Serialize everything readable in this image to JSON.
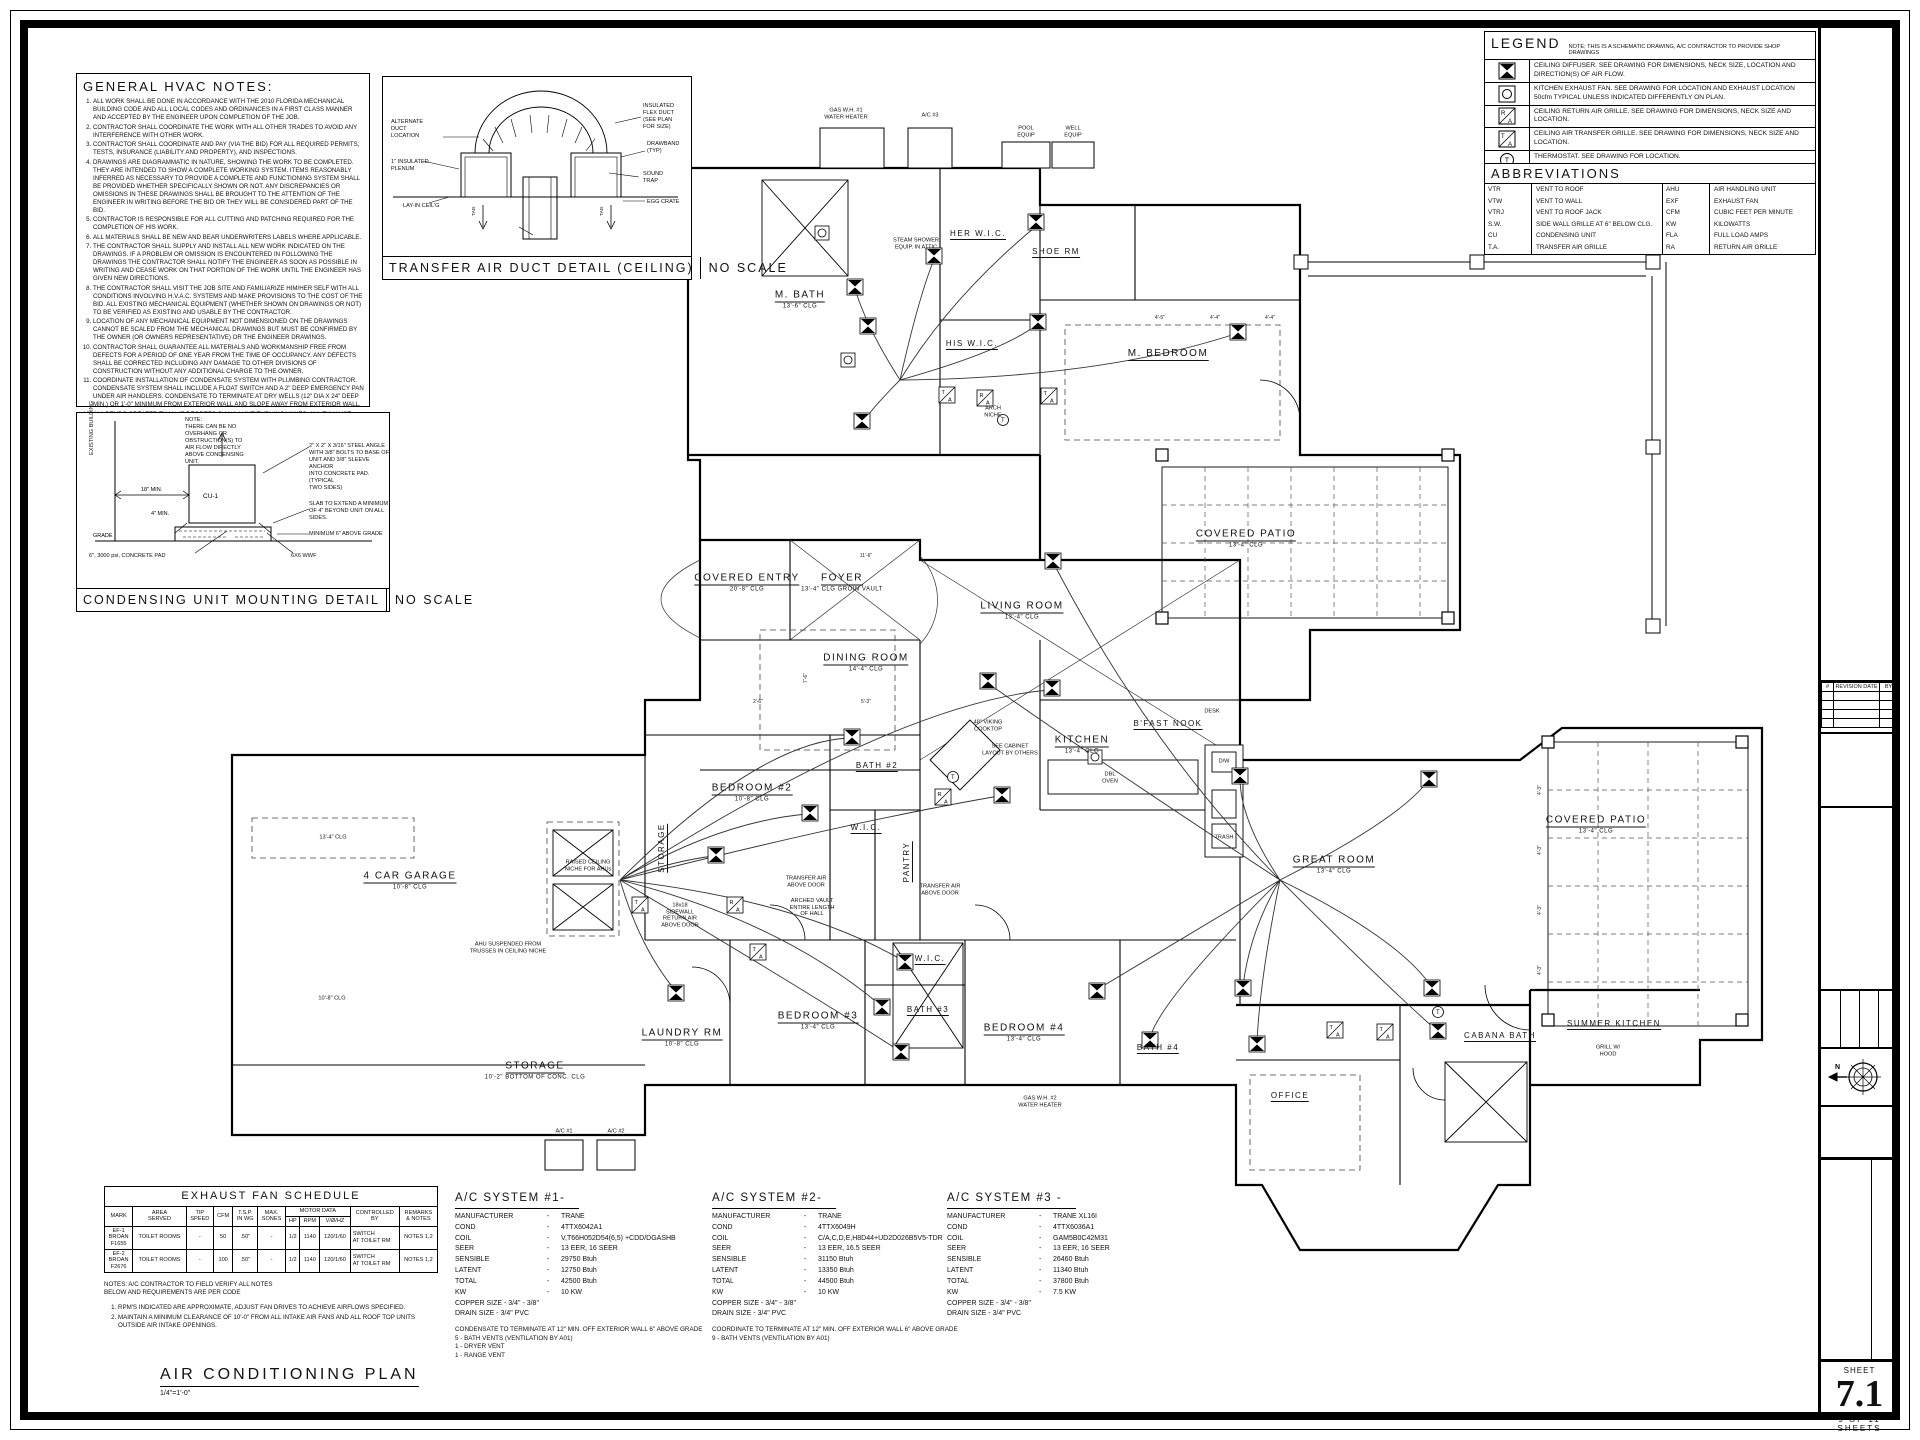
{
  "general_notes": {
    "title": "GENERAL HVAC NOTES:",
    "items": [
      "ALL WORK SHALL BE DONE IN ACCORDANCE WITH THE 2010 FLORIDA MECHANICAL BUILDING CODE AND ALL LOCAL CODES AND ORDINANCES IN A FIRST CLASS MANNER AND ACCEPTED BY THE ENGINEER UPON COMPLETION OF THE JOB.",
      "CONTRACTOR SHALL COORDINATE THE WORK WITH ALL OTHER TRADES TO AVOID ANY INTERFERENCE WITH OTHER WORK.",
      "CONTRACTOR SHALL COORDINATE AND PAY (VIA THE BID) FOR ALL REQUIRED PERMITS, TESTS, INSURANCE (LIABILITY AND PROPERTY), AND INSPECTIONS.",
      "DRAWINGS ARE DIAGRAMMATIC IN NATURE, SHOWING THE WORK TO BE COMPLETED. THEY ARE INTENDED TO SHOW A COMPLETE WORKING SYSTEM. ITEMS REASONABLY INFERRED AS NECESSARY TO PROVIDE A COMPLETE AND FUNCTIONING SYSTEM SHALL BE PROVIDED WHETHER SPECIFICALLY SHOWN OR NOT. ANY DISCREPANCIES OR OMISSIONS IN THESE DRAWINGS SHALL BE BROUGHT TO THE ATTENTION OF THE ENGINEER IN WRITING BEFORE THE BID OR THEY WILL BE CONSIDERED PART OF THE BID.",
      "CONTRACTOR IS RESPONSIBLE FOR ALL CUTTING AND PATCHING REQUIRED FOR THE COMPLETION OF HIS WORK.",
      "ALL MATERIALS SHALL BE NEW AND BEAR UNDERWRITERS LABELS WHERE APPLICABLE.",
      "THE CONTRACTOR SHALL SUPPLY AND INSTALL ALL NEW WORK INDICATED ON THE DRAWINGS. IF A PROBLEM OR OMISSION IS ENCOUNTERED IN FOLLOWING THE DRAWINGS THE CONTRACTOR SHALL NOTIFY THE ENGINEER AS SOON AS POSSIBLE IN WRITING AND CEASE WORK ON THAT PORTION OF THE WORK UNTIL THE ENGINEER HAS GIVEN NEW DIRECTIONS.",
      "THE CONTRACTOR SHALL VISIT THE JOB SITE AND FAMILIARIZE HIM/HER SELF WITH ALL CONDITIONS INVOLVING H.V.A.C. SYSTEMS AND MAKE PROVISIONS TO THE COST OF THE BID. ALL EXISTING MECHANICAL EQUIPMENT (WHETHER SHOWN ON DRAWINGS OR NOT) TO BE VERIFIED AS EXISTING AND USABLE BY THE CONTRACTOR.",
      "LOCATION OF ANY MECHANICAL EQUIPMENT NOT DIMENSIONED ON THE DRAWINGS CANNOT BE SCALED FROM THE MECHANICAL DRAWINGS BUT MUST BE CONFIRMED BY THE OWNER (OR OWNERS REPRESENTATIVE) OR THE ENGINEER DRAWINGS.",
      "CONTRACTOR SHALL GUARANTEE ALL MATERIALS AND WORKMANSHIP FREE FROM DEFECTS FOR A PERIOD OF ONE YEAR FROM THE TIME OF OCCUPANCY. ANY DEFECTS SHALL BE CORRECTED INCLUDING ANY DAMAGE TO OTHER DIVISIONS OF CONSTRUCTION WITHOUT ANY ADDITIONAL CHARGE TO THE OWNER.",
      "COORDINATE INSTALLATION OF CONDENSATE SYSTEM WITH PLUMBING CONTRACTOR. CONDENSATE SYSTEM SHALL INCLUDE A FLOAT SWITCH AND A 2\" DEEP EMERGENCY PAN UNDER AIR HANDLERS. CONDENSATE TO TERMINATE AT DRY WELLS (12\" DIA X 24\" DEEP MIN.) OR 1'-0\" MINIMUM FROM EXTERIOR WALL AND SLOPE AWAY FROM EXTERIOR WALL.",
      "ALL BENDS GREATER THAN 45 DEGREES SHALL HAVE TURNING VANES. ALL EXHAUST DUCTWORK TO BE SHEETMETAL.",
      "CONTRACTOR SHALL PROVIDE TEST AND BALANCE REPORT",
      "ALL GRILLES SHALL BE FULLY ADJUSTABLE ALUMINUM GRILLES WHITE ESP FINISH, METALAIRE OR APPROVED EQUAL.",
      "PROVIDE A PROGRAMMABLE THERMOSTAT FOR EACH AIR HANDLING UNIT, UNIT SHALL NOT HAVE ANY VISIBLE NAMEPLATES.",
      "ALL NEW EQUIPMENT TRANE OR EQUAL",
      "VERIFY ALL DUCT SIZE, INSULATION, WITH ENERGY CODES AND ENERGY CALCS SUPPLIED.",
      "HOLD ALL WALL MOUNTED DIFFUSERS 10\" BELOW INTERSECTION OF WALL/ CEILING.",
      "EXHAUST FANS IN BATHROOMS (IF USED) SHALL BE RATED AT 1 CFM/SF OF VENTILATED FLOOR AREA.",
      "ALL FAN VENTING AND ROOF PENETRATIONS SHALL BE BY MECHANICAL CONTRACTOR."
    ]
  },
  "transfer_detail": {
    "title": "TRANSFER AIR DUCT DETAIL (CEILING)",
    "scale": "NO SCALE",
    "labels": {
      "alternate": "ALTERNATE\nDUCT\nLOCATION",
      "plenum": "1\" INSULATED\nPLENUM",
      "layin": "LAY-IN CEIL'G",
      "flex": "INSULATED\nFLEX DUCT\n(SEE PLAN\nFOR SIZE)",
      "drawband": "DRAWBAND\n(TYP)",
      "sound": "SOUND\nTRAP",
      "eggcrate": "EGG CRATE",
      "tag1": "TAG",
      "tag2": "TAG"
    }
  },
  "condensing_detail": {
    "title": "CONDENSING UNIT MOUNTING DETAIL",
    "scale": "NO SCALE",
    "labels": {
      "note": "NOTE:\nTHERE CAN BE NO\nOVERHANG OR\nOBSTRUCTION(S) TO\nAIR FLOW DIRECTLY\nABOVE CONDENSING\nUNIT.",
      "existing": "EXISTING BUILDING",
      "dim18": "18\" MIN.",
      "cu": "CU-1",
      "dim4": "4\" MIN.",
      "grade": "GRADE",
      "angle": "2\" X 2\" X 3/16\" STEEL ANGLE\nWITH 3/8\" BOLTS TO BASE OF\nUNIT AND 3/8\" SLEEVE ANCHOR\nINTO CONCRETE PAD. (TYPICAL\nTWO SIDES)",
      "slab": "SLAB TO EXTEND A MINIMUM\nOF 4\" BEYOND UNIT ON ALL\nSIDES.",
      "above": "MINIMUM 6\" ABOVE GRADE",
      "pad": "6\", 3000 psi, CONCRETE PAD",
      "wwf": "6X6 WWF"
    }
  },
  "legend": {
    "title": "LEGEND",
    "note": "NOTE: THIS IS A SCHEMATIC DRAWING, A/C CONTRACTOR TO PROVIDE SHOP DRAWINGS",
    "rows": [
      {
        "icon": "ceiling-diffuser-icon",
        "text": "CEILING DIFFUSER. SEE DRAWING FOR DIMENSIONS, NECK SIZE, LOCATION AND DIRECTION(S) OF AIR FLOW."
      },
      {
        "icon": "kitchen-exhaust-fan-icon",
        "text": "KITCHEN EXHAUST FAN. SEE DRAWING FOR LOCATION AND EXHAUST LOCATION 50cfm TYPICAL UNLESS INDICATED DIFFERENTLY ON PLAN."
      },
      {
        "icon": "return-air-grille-icon",
        "text": "CEILING RETURN AIR GRILLE. SEE DRAWING FOR DIMENSIONS, NECK SIZE AND LOCATION."
      },
      {
        "icon": "transfer-air-grille-icon",
        "text": "CEILING AIR TRANSFER GRILLE. SEE DRAWING FOR DIMENSIONS, NECK SIZE AND LOCATION."
      },
      {
        "icon": "thermostat-icon",
        "text": "THERMOSTAT. SEE DRAWING FOR LOCATION."
      }
    ]
  },
  "abbreviations": {
    "title": "ABBREVIATIONS",
    "left": [
      {
        "k": "VTR",
        "v": "VENT TO ROOF"
      },
      {
        "k": "VTW",
        "v": "VENT TO WALL"
      },
      {
        "k": "VTRJ",
        "v": "VENT TO ROOF JACK"
      },
      {
        "k": "S.W.",
        "v": "SIDE WALL GRILLE AT 6\" BELOW CLG."
      },
      {
        "k": "CU",
        "v": "CONDENSING UNIT"
      },
      {
        "k": "T.A.",
        "v": "TRANSFER AIR GRILLE"
      }
    ],
    "right": [
      {
        "k": "AHU",
        "v": "AIR HANDLING UNIT"
      },
      {
        "k": "EXF",
        "v": "EXHAUST FAN"
      },
      {
        "k": "CFM",
        "v": "CUBIC FEET PER MINUTE"
      },
      {
        "k": "KW",
        "v": "KILOWATTS"
      },
      {
        "k": "FLA",
        "v": "FULL LOAD AMPS"
      },
      {
        "k": "RA",
        "v": "RETURN AIR GRILLE"
      }
    ]
  },
  "exhaust_schedule": {
    "title": "EXHAUST FAN SCHEDULE",
    "headers": {
      "mark": "MARK",
      "area": "AREA\nSERVED",
      "tip": "TIP\nSPEED",
      "cfm": "CFM",
      "tsp": "T.S.P.\nIN WG",
      "sones": "MAX.\nSONES",
      "motor": "MOTOR DATA",
      "hp": "HP",
      "rpm": "RPM",
      "v": "V/Ø/HZ",
      "ctrl": "CONTROLLED\nBY",
      "rem": "REMARKS\n& NOTES"
    },
    "rows": [
      [
        "EF-1\nBROAN\nF1655",
        "TOILET ROOMS",
        "-",
        "50",
        ".50\"",
        "-",
        "1/2",
        "1140",
        "120/1/60",
        "SWITCH\nAT TOILET RM",
        "NOTES 1,2"
      ],
      [
        "EF-2\nBROAN\nF2676",
        "TOILET ROOMS",
        "-",
        "100",
        ".50\"",
        "-",
        "1/2",
        "1140",
        "120/1/60",
        "SWITCH\nAT TOILET RM",
        "NOTES 1,2"
      ]
    ],
    "notes_head": "NOTES: A/C CONTRACTOR TO FIELD VERIFY ALL NOTES\nBELOW AND REQUIREMENTS ARE PER CODE",
    "notes": [
      "RPM'S INDICATED ARE APPROXIMATE, ADJUST FAN DRIVES TO ACHIEVE AIRFLOWS SPECIFIED.",
      "MAINTAIN A MINIMUM CLEARANCE OF 10'-0\" FROM ALL INTAKE AIR FANS AND ALL ROOF TOP UNITS OUTSIDE AIR INTAKE OPENINGS."
    ]
  },
  "ac_systems": [
    {
      "title": "A/C SYSTEM #1-",
      "rows": [
        [
          "MANUFACTURER",
          "TRANE"
        ],
        [
          "COND",
          "4TTX6042A1"
        ],
        [
          "COIL",
          "V,T66H052D54(6,5) +CDD/DGASHB"
        ],
        [
          "SEER",
          "13 EER, 16 SEER"
        ],
        [
          "SENSIBLE",
          "29750   Btuh"
        ],
        [
          "LATENT",
          "12750   Btuh"
        ],
        [
          "TOTAL",
          "42500   Btuh"
        ],
        [
          "KW",
          "10 KW"
        ]
      ],
      "copper": "COPPER SIZE - 3/4\" - 3/8\"",
      "drain": "DRAIN SIZE   - 3/4\" PVC",
      "notes": "CONDENSATE TO TERMINATE AT 12\" MIN. OFF EXTERIOR WALL 6\" ABOVE GRADE\n5 - BATH VENTS          (VENTILATION BY A01)\n1 - DRYER VENT\n1 - RANGE VENT"
    },
    {
      "title": "A/C SYSTEM #2-",
      "rows": [
        [
          "MANUFACTURER",
          "TRANE"
        ],
        [
          "COND",
          "4TTX6049H"
        ],
        [
          "COIL",
          "C/A,C,D,E,H8D44+UD2D026B5V5-TDR"
        ],
        [
          "SEER",
          "13 EER, 16.5 SEER"
        ],
        [
          "SENSIBLE",
          "31150   Btuh"
        ],
        [
          "LATENT",
          "13350   Btuh"
        ],
        [
          "TOTAL",
          "44500   Btuh"
        ],
        [
          "KW",
          "10 KW"
        ]
      ],
      "copper": "COPPER SIZE - 3/4\" - 3/8\"",
      "drain": "DRAIN SIZE   - 3/4\" PVC",
      "notes": "COORDINATE TO TERMINATE AT 12\" MIN. OFF EXTERIOR WALL 6\" ABOVE GRADE\n9 - BATH VENTS          (VENTILATION BY A01)"
    },
    {
      "title": "A/C SYSTEM #3 -",
      "rows": [
        [
          "MANUFACTURER",
          "TRANE XL16I"
        ],
        [
          "COND",
          "4TTX6036A1"
        ],
        [
          "COIL",
          "GAM5B0C42M31"
        ],
        [
          "SEER",
          "13 EER, 16 SEER"
        ],
        [
          "SENSIBLE",
          "26460   Btuh"
        ],
        [
          "LATENT",
          "11340   Btuh"
        ],
        [
          "TOTAL",
          "37800   Btuh"
        ],
        [
          "KW",
          "7.5 KW"
        ]
      ],
      "copper": "COPPER SIZE - 3/4\" - 3/8\"",
      "drain": "DRAIN SIZE   - 3/4\" PVC",
      "notes": ""
    }
  ],
  "plan": {
    "title": "AIR CONDITIONING PLAN",
    "scale": "1/4\"=1'-0\"",
    "rooms": [
      {
        "label": "M. BATH",
        "sub": "13'-6\" CLG"
      },
      {
        "label": "HER\nW.I.C.",
        "sub": ""
      },
      {
        "label": "SHOE RM",
        "sub": ""
      },
      {
        "label": "HIS\nW.I.C.",
        "sub": ""
      },
      {
        "label": "M. BEDROOM",
        "sub": ""
      },
      {
        "label": "COVERED PATIO",
        "sub": "13'-4\" CLG"
      },
      {
        "label": "COVERED\nENTRY",
        "sub": "20'-8\" CLG"
      },
      {
        "label": "FOYER",
        "sub": "13'-4\" CLG\nGROIN VAULT"
      },
      {
        "label": "LIVING ROOM",
        "sub": "13'-4\" CLG"
      },
      {
        "label": "DINING ROOM",
        "sub": "14'-4\" CLG"
      },
      {
        "label": "KITCHEN",
        "sub": "13'-4\" CLG"
      },
      {
        "label": "B'FAST NOOK",
        "sub": ""
      },
      {
        "label": "GREAT ROOM",
        "sub": "13'-4\" CLG"
      },
      {
        "label": "COVERED PATIO",
        "sub": "13'-4\" CLG"
      },
      {
        "label": "BEDROOM #2",
        "sub": "10'-8\" CLG"
      },
      {
        "label": "BATH #2",
        "sub": ""
      },
      {
        "label": "W.I.C.",
        "sub": ""
      },
      {
        "label": "PANTRY",
        "sub": ""
      },
      {
        "label": "4 CAR GARAGE",
        "sub": "10'-8\" CLG"
      },
      {
        "label": "STORAGE",
        "sub": ""
      },
      {
        "label": "LAUNDRY RM",
        "sub": "10'-8\" CLG"
      },
      {
        "label": "BEDROOM #3",
        "sub": "13'-4\" CLG"
      },
      {
        "label": "BATH #3",
        "sub": ""
      },
      {
        "label": "W.I.C.",
        "sub": ""
      },
      {
        "label": "BEDROOM #4",
        "sub": "13'-4\" CLG"
      },
      {
        "label": "BATH #4",
        "sub": ""
      },
      {
        "label": "OFFICE",
        "sub": ""
      },
      {
        "label": "CABANA\nBATH",
        "sub": ""
      },
      {
        "label": "SUMMER\nKITCHEN",
        "sub": ""
      },
      {
        "label": "STORAGE",
        "sub": "10'-2\"  BOTTOM OF CONC. CLG"
      }
    ],
    "annotations": [
      "GAS W.H. #1\nWATER HEATER",
      "A/C #3",
      "POOL\nEQUIP",
      "WELL\nEQUIP",
      "STEAM SHOWER\nEQUIP. IN ATTIC",
      "ARCH\nNICHE",
      "48\" VIKING\nCOOKTOP",
      "SEE CABINET\nLAYOUT BY OTHERS",
      "DESK",
      "D/W",
      "DBL\nOVEN",
      "TRASH",
      "AHU SUSPENDED FROM\nTRUSSES IN CEILING NICHE",
      "RAISED CEILING\nNICHE FOR AHUs",
      "18x18\nSIDEWALL\nRETURN AIR\nABOVE DOOR",
      "TRANSFER AIR\nABOVE DOOR",
      "TRANSFER AIR\nABOVE DOOR",
      "ARCHED VAULT\nENTIRE LENGTH\nOF HALL",
      "GAS W.H. #2\nWATER HEATER",
      "A/C #1",
      "A/C #2",
      "GRILL W/\nHOOD",
      "13'-4\" CLG",
      "10'-8\" CLG"
    ],
    "dims": [
      "4'-5\"",
      "4'-4\"",
      "4'-4\"",
      "4'-3\"",
      "4'-3\"",
      "4'-3\"",
      "4'-3\"",
      "11'-6\"",
      "5'-3\"",
      "7'-6\"",
      "2'-6\""
    ]
  },
  "title_block": {
    "revision": {
      "num": "#",
      "date": "REVISION DATE",
      "by": "BY"
    },
    "company": {
      "name": "DesignDrafting78.com, Inc.",
      "tagline": "Custom Design and Contract Drafting",
      "phone": "OFFICE: (561) 693-7731",
      "email": "email: andrew@designdrafting78.com",
      "address": "Office: 4872 Coconut Blvd, Royal Palm Beach, FL 33411"
    },
    "info": {
      "date_label": "DATE",
      "date": "11-20-2014",
      "scale_label": "SCALE",
      "scale": "1/4\"=1'-0\"",
      "project_label": "PROJECT NUMBER",
      "project": "14-0602",
      "drawn_label": "DRAWN BY",
      "drawn": ""
    },
    "state": "FLORIDA",
    "client": {
      "for": "NEW RESIDENCE FOR:",
      "name": "WIGHTMAN RESIDENCE",
      "lot": "LOT #119 HOMELAND",
      "county": "PALM BEACH COUNTY"
    },
    "sheet_title": "AIR CONDITIONING PLAN",
    "sheet": {
      "label": "SHEET",
      "number": "7.1",
      "count": "9   OF   11   SHEETS"
    }
  }
}
